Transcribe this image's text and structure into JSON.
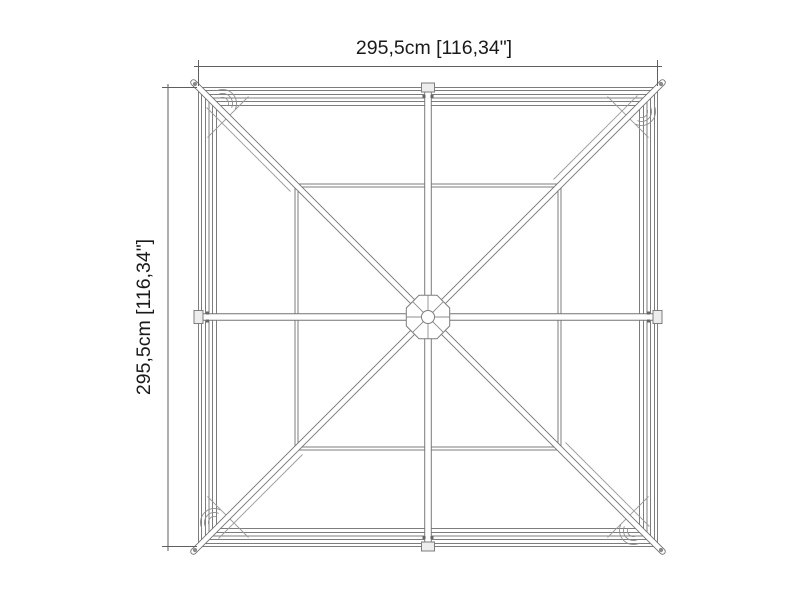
{
  "drawing": {
    "dimension_width_label": "295,5cm [116,34\"]",
    "dimension_height_label": "295,5cm [116,34\"]"
  },
  "colors": {
    "background": "#ffffff",
    "frame_line": "#7d7d7d",
    "brace_line": "#747474",
    "detail_line": "#9a9a9a",
    "dimension_line": "#5f5f5f",
    "tab_fill": "#ededed",
    "joint_mark": "#666666",
    "text": "#1a1a1a"
  }
}
